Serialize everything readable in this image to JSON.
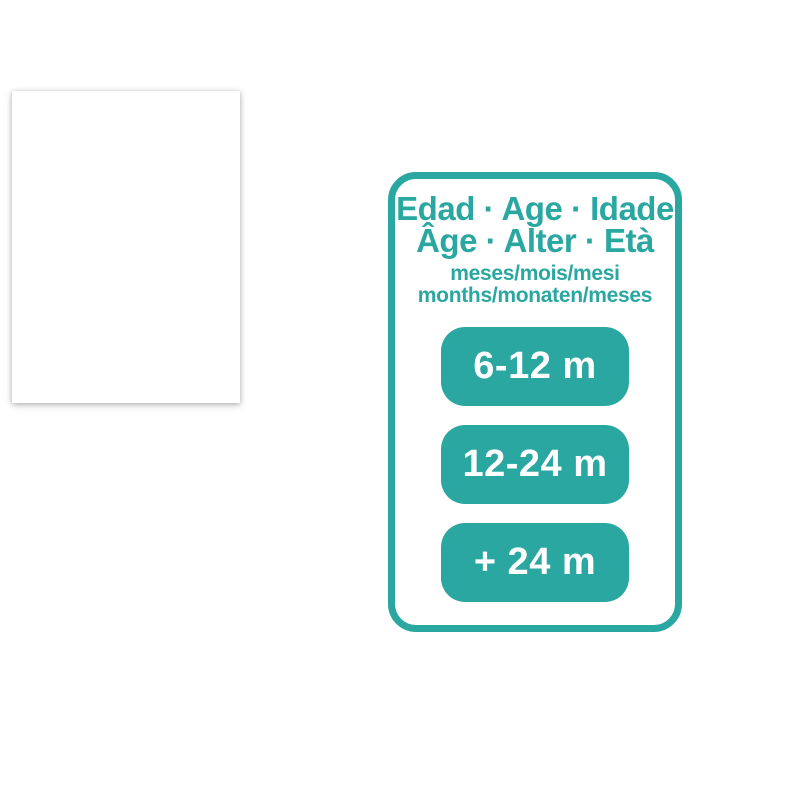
{
  "page": {
    "background_color": "#ffffff",
    "accent_color": "#2aa7a0"
  },
  "age_card": {
    "title_line1": "Edad · Age · Idade",
    "title_line2": "Âge · Alter · Età",
    "subtitle_line1": "meses/mois/mesi",
    "subtitle_line2": "months/monaten/meses",
    "buttons": [
      {
        "label": "6-12 m"
      },
      {
        "label": "12-24 m"
      },
      {
        "label": "+ 24 m"
      }
    ]
  }
}
